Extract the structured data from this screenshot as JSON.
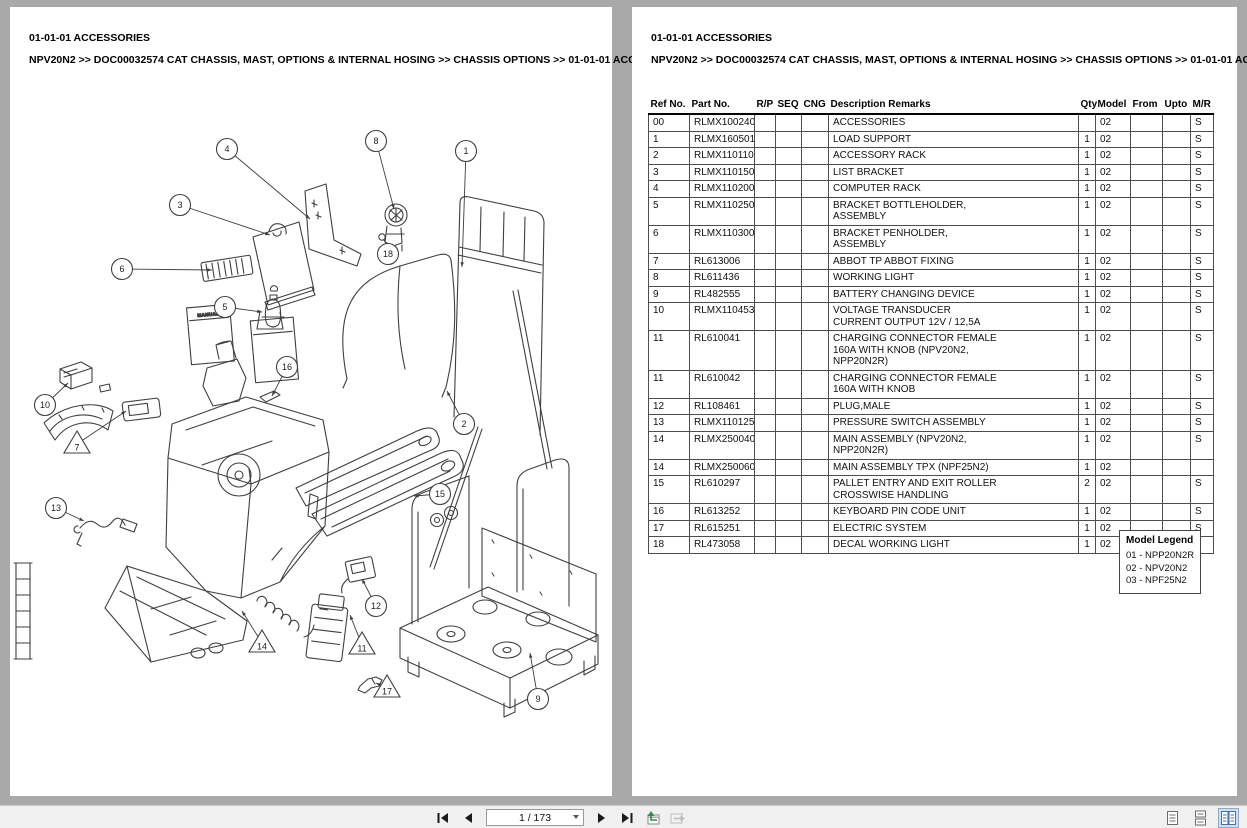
{
  "page_left": {
    "title": "01-01-01 ACCESSORIES",
    "breadcrumb": "NPV20N2 >> DOC00032574 CAT CHASSIS, MAST, OPTIONS & INTERNAL HOSING >> CHASSIS OPTIONS >> 01-01-01 ACCESSORIES"
  },
  "page_right": {
    "title": "01-01-01 ACCESSORIES",
    "breadcrumb": "NPV20N2 >> DOC00032574 CAT CHASSIS, MAST, OPTIONS & INTERNAL HOSING >> CHASSIS OPTIONS >> 01-01-01 ACCESSORIES",
    "table": {
      "headers": [
        "Ref No.",
        "Part No.",
        "R/P",
        "SEQ",
        "CNG",
        "Description Remarks",
        "Qty",
        "Model",
        "From",
        "Upto",
        "M/R"
      ],
      "rows": [
        {
          "ref": "00",
          "part": "RLMX100240",
          "rp": "",
          "seq": "",
          "cng": "",
          "desc": "ACCESSORIES",
          "qty": "",
          "model": "02",
          "from": "",
          "upto": "",
          "mr": "S"
        },
        {
          "ref": "1",
          "part": "RLMX160501",
          "rp": "",
          "seq": "",
          "cng": "",
          "desc": "LOAD SUPPORT",
          "qty": "1",
          "model": "02",
          "from": "",
          "upto": "",
          "mr": "S"
        },
        {
          "ref": "2",
          "part": "RLMX110110",
          "rp": "",
          "seq": "",
          "cng": "",
          "desc": "ACCESSORY RACK",
          "qty": "1",
          "model": "02",
          "from": "",
          "upto": "",
          "mr": "S"
        },
        {
          "ref": "3",
          "part": "RLMX110150",
          "rp": "",
          "seq": "",
          "cng": "",
          "desc": "LIST BRACKET",
          "qty": "1",
          "model": "02",
          "from": "",
          "upto": "",
          "mr": "S"
        },
        {
          "ref": "4",
          "part": "RLMX110200",
          "rp": "",
          "seq": "",
          "cng": "",
          "desc": "COMPUTER RACK",
          "qty": "1",
          "model": "02",
          "from": "",
          "upto": "",
          "mr": "S"
        },
        {
          "ref": "5",
          "part": "RLMX110250",
          "rp": "",
          "seq": "",
          "cng": "",
          "desc": "BRACKET BOTTLEHOLDER,\nASSEMBLY",
          "qty": "1",
          "model": "02",
          "from": "",
          "upto": "",
          "mr": "S"
        },
        {
          "ref": "6",
          "part": "RLMX110300",
          "rp": "",
          "seq": "",
          "cng": "",
          "desc": "BRACKET PENHOLDER,\nASSEMBLY",
          "qty": "1",
          "model": "02",
          "from": "",
          "upto": "",
          "mr": "S"
        },
        {
          "ref": "7",
          "part": "RL613006",
          "rp": "",
          "seq": "",
          "cng": "",
          "desc": "ABBOT TP ABBOT FIXING",
          "qty": "1",
          "model": "02",
          "from": "",
          "upto": "",
          "mr": "S"
        },
        {
          "ref": "8",
          "part": "RL611436",
          "rp": "",
          "seq": "",
          "cng": "",
          "desc": "WORKING LIGHT",
          "qty": "1",
          "model": "02",
          "from": "",
          "upto": "",
          "mr": "S"
        },
        {
          "ref": "9",
          "part": "RL482555",
          "rp": "",
          "seq": "",
          "cng": "",
          "desc": "BATTERY CHANGING DEVICE",
          "qty": "1",
          "model": "02",
          "from": "",
          "upto": "",
          "mr": "S"
        },
        {
          "ref": "10",
          "part": "RLMX110453",
          "rp": "",
          "seq": "",
          "cng": "",
          "desc": "VOLTAGE TRANSDUCER\nCURRENT OUTPUT 12V / 12,5A",
          "qty": "1",
          "model": "02",
          "from": "",
          "upto": "",
          "mr": "S"
        },
        {
          "ref": "11",
          "part": "RL610041",
          "rp": "",
          "seq": "",
          "cng": "",
          "desc": "CHARGING CONNECTOR FEMALE\n160A WITH KNOB (NPV20N2,\nNPP20N2R)",
          "qty": "1",
          "model": "02",
          "from": "",
          "upto": "",
          "mr": "S"
        },
        {
          "ref": "11",
          "part": "RL610042",
          "rp": "",
          "seq": "",
          "cng": "",
          "desc": "CHARGING CONNECTOR FEMALE\n160A WITH KNOB",
          "qty": "1",
          "model": "02",
          "from": "",
          "upto": "",
          "mr": "S"
        },
        {
          "ref": "12",
          "part": "RL108461",
          "rp": "",
          "seq": "",
          "cng": "",
          "desc": "PLUG,MALE",
          "qty": "1",
          "model": "02",
          "from": "",
          "upto": "",
          "mr": "S"
        },
        {
          "ref": "13",
          "part": "RLMX110125",
          "rp": "",
          "seq": "",
          "cng": "",
          "desc": "PRESSURE SWITCH ASSEMBLY",
          "qty": "1",
          "model": "02",
          "from": "",
          "upto": "",
          "mr": "S"
        },
        {
          "ref": "14",
          "part": "RLMX250040",
          "rp": "",
          "seq": "",
          "cng": "",
          "desc": "MAIN ASSEMBLY (NPV20N2,\nNPP20N2R)",
          "qty": "1",
          "model": "02",
          "from": "",
          "upto": "",
          "mr": "S"
        },
        {
          "ref": "14",
          "part": "RLMX250060",
          "rp": "",
          "seq": "",
          "cng": "",
          "desc": "MAIN ASSEMBLY TPX (NPF25N2)",
          "qty": "1",
          "model": "02",
          "from": "",
          "upto": "",
          "mr": ""
        },
        {
          "ref": "15",
          "part": "RL610297",
          "rp": "",
          "seq": "",
          "cng": "",
          "desc": "PALLET ENTRY AND EXIT ROLLER\nCROSSWISE HANDLING",
          "qty": "2",
          "model": "02",
          "from": "",
          "upto": "",
          "mr": "S"
        },
        {
          "ref": "16",
          "part": "RL613252",
          "rp": "",
          "seq": "",
          "cng": "",
          "desc": "KEYBOARD PIN CODE UNIT",
          "qty": "1",
          "model": "02",
          "from": "",
          "upto": "",
          "mr": "S"
        },
        {
          "ref": "17",
          "part": "RL615251",
          "rp": "",
          "seq": "",
          "cng": "",
          "desc": "ELECTRIC SYSTEM",
          "qty": "1",
          "model": "02",
          "from": "",
          "upto": "",
          "mr": "S"
        },
        {
          "ref": "18",
          "part": "RL473058",
          "rp": "",
          "seq": "",
          "cng": "",
          "desc": "DECAL WORKING LIGHT",
          "qty": "1",
          "model": "02",
          "from": "",
          "upto": "",
          "mr": ""
        }
      ]
    },
    "model_legend": {
      "title": "Model Legend",
      "items": [
        "01 - NPP20N2R",
        "02 - NPV20N2",
        "03 - NPF25N2"
      ]
    }
  },
  "diagram": {
    "label_manual": "MANUAL",
    "callouts": [
      {
        "num": "4",
        "shape": "circle",
        "x": 217,
        "y": 142,
        "tx": 300,
        "ty": 212
      },
      {
        "num": "8",
        "shape": "circle",
        "x": 366,
        "y": 134,
        "tx": 384,
        "ty": 202
      },
      {
        "num": "1",
        "shape": "circle",
        "x": 456,
        "y": 144,
        "tx": 452,
        "ty": 260
      },
      {
        "num": "3",
        "shape": "circle",
        "x": 170,
        "y": 198,
        "tx": 260,
        "ty": 228
      },
      {
        "num": "18",
        "shape": "circle",
        "x": 378,
        "y": 247,
        "tx": 375,
        "ty": 237
      },
      {
        "num": "6",
        "shape": "circle",
        "x": 112,
        "y": 262,
        "tx": 202,
        "ty": 263
      },
      {
        "num": "5",
        "shape": "circle",
        "x": 215,
        "y": 300,
        "tx": 252,
        "ty": 305
      },
      {
        "num": "16",
        "shape": "circle",
        "x": 277,
        "y": 360,
        "tx": 262,
        "ty": 389
      },
      {
        "num": "10",
        "shape": "circle",
        "x": 35,
        "y": 398,
        "tx": 58,
        "ty": 376
      },
      {
        "num": "7",
        "shape": "triangle",
        "x": 67,
        "y": 437,
        "tx": 116,
        "ty": 404
      },
      {
        "num": "2",
        "shape": "circle",
        "x": 454,
        "y": 417,
        "tx": 437,
        "ty": 384
      },
      {
        "num": "15",
        "shape": "circle",
        "x": 430,
        "y": 487,
        "tx": 404,
        "ty": 489
      },
      {
        "num": "13",
        "shape": "circle",
        "x": 46,
        "y": 501,
        "tx": 74,
        "ty": 514
      },
      {
        "num": "12",
        "shape": "circle",
        "x": 366,
        "y": 599,
        "tx": 352,
        "ty": 572
      },
      {
        "num": "14",
        "shape": "triangle",
        "x": 252,
        "y": 636,
        "tx": 232,
        "ty": 604
      },
      {
        "num": "11",
        "shape": "triangle",
        "x": 352,
        "y": 638,
        "tx": 340,
        "ty": 608
      },
      {
        "num": "17",
        "shape": "triangle",
        "x": 377,
        "y": 681,
        "tx": 366,
        "ty": 676
      },
      {
        "num": "9",
        "shape": "circle",
        "x": 528,
        "y": 692,
        "tx": 520,
        "ty": 646
      }
    ]
  },
  "toolbar": {
    "page_indicator": "1 / 173",
    "icons": {
      "first_page": "first-page-icon",
      "previous_page": "previous-page-icon",
      "next_page": "next-page-icon",
      "last_page": "last-page-icon",
      "previous_view": "previous-view-icon",
      "next_view": "next-view-icon",
      "single_page_view": "single-page-view-icon",
      "continuous_view": "continuous-view-icon",
      "two_page_view": "two-page-view-icon"
    },
    "selected_view": "two_page_view"
  },
  "colors": {
    "viewer_bg": "#a9a9a9",
    "page_bg": "#ffffff",
    "toolbar_bg": "#f0f0f0",
    "selected_view_bg": "#cfe0f5",
    "selected_view_border": "#86abd4",
    "line_art": "#3f3f3f",
    "prev_view_arrow": "#2e8b57"
  }
}
